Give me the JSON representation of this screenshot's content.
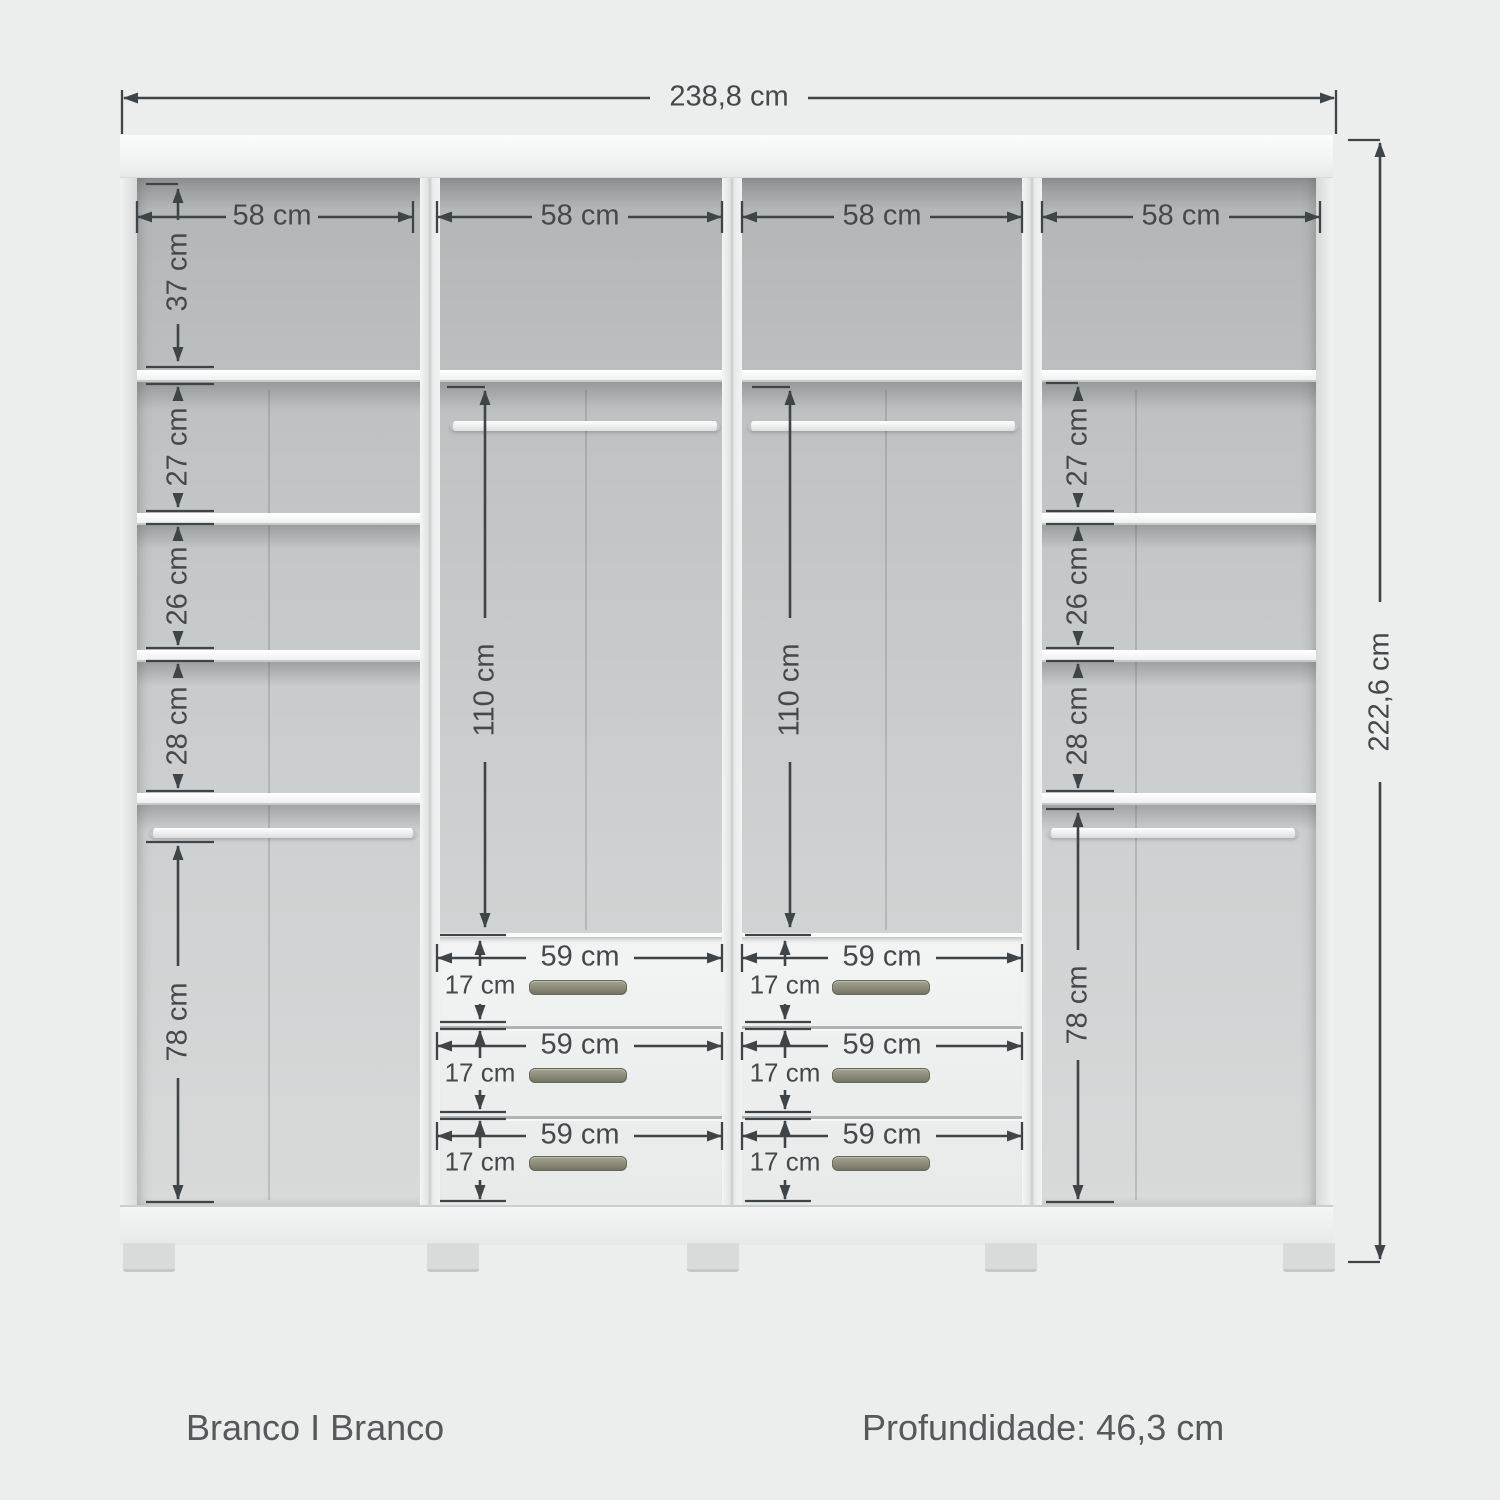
{
  "footer": {
    "finish": "Branco I Branco",
    "depth": "Profundidade: 46,3 cm"
  },
  "dimensions": {
    "overall_width": "238,8 cm",
    "overall_height": "222,6 cm",
    "section_widths": [
      "58 cm",
      "58 cm",
      "58 cm",
      "58 cm"
    ],
    "left_shelves": [
      "37 cm",
      "27 cm",
      "26 cm",
      "28 cm",
      "78 cm"
    ],
    "right_shelves": [
      "27 cm",
      "26 cm",
      "28 cm",
      "78 cm"
    ],
    "hanging": [
      "110 cm",
      "110 cm"
    ],
    "drawer_widths": [
      "59 cm",
      "59 cm",
      "59 cm",
      "59 cm",
      "59 cm",
      "59 cm"
    ],
    "drawer_heights": [
      "17 cm",
      "17 cm",
      "17 cm",
      "17 cm",
      "17 cm",
      "17 cm"
    ]
  },
  "colors": {
    "background": "#eceded",
    "dimension_line": "#3f4446",
    "label_text": "#46494b",
    "handle": "#8f8f7e",
    "panel_white": "#f5f6f6",
    "interior_grey": "#c3c6c6",
    "footer_text": "#57585a"
  }
}
